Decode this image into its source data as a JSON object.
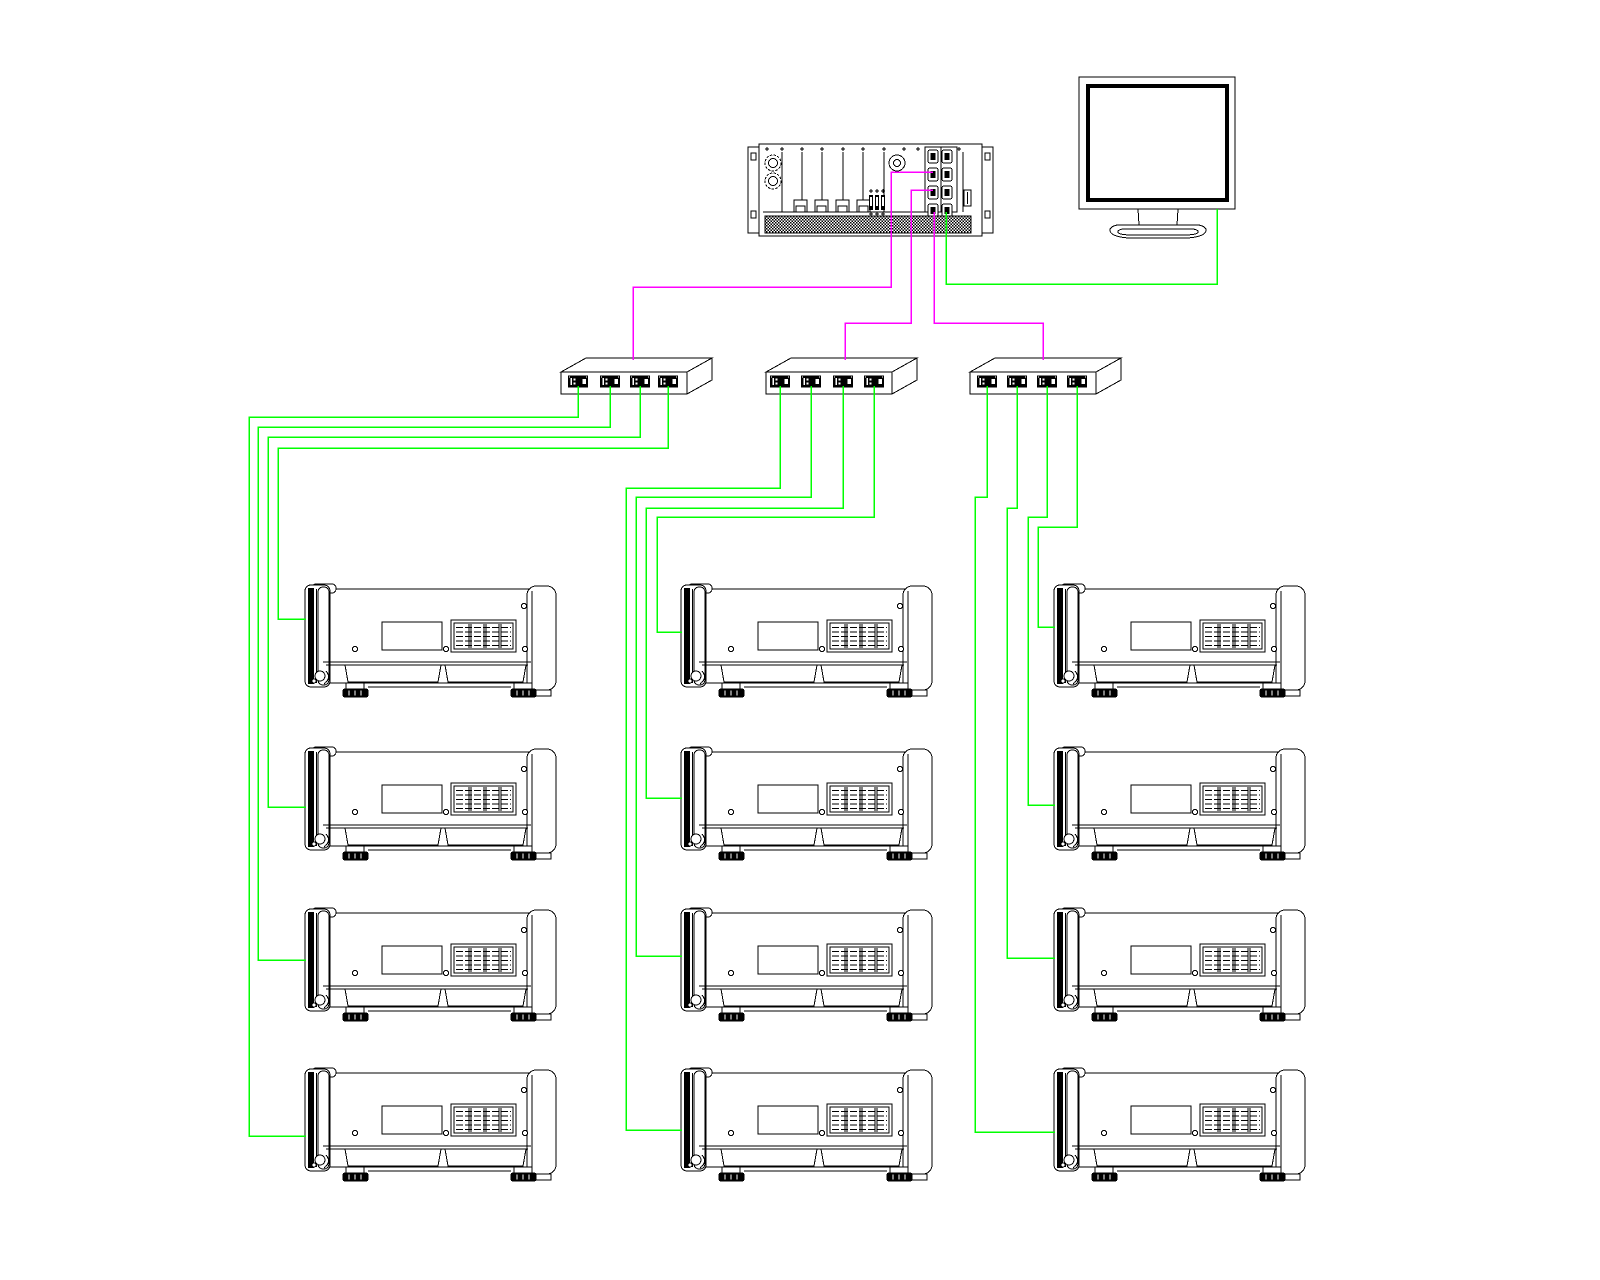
{
  "diagram": {
    "canvas": {
      "width": 1600,
      "height": 1280,
      "background": "#ffffff",
      "ink": "#000000"
    },
    "colors": {
      "video": "#ff00ff",
      "lan": "#00ff00"
    },
    "server": {
      "id": "rack-media-server",
      "x": 748,
      "y": 144,
      "width": 245,
      "height": 92
    },
    "monitor": {
      "id": "control-monitor",
      "x": 1079,
      "y": 77,
      "width": 156,
      "height": 161
    },
    "switches": [
      {
        "id": "splitter-1",
        "x": 561,
        "y": 358,
        "ports_x": [
          578,
          610,
          640,
          668
        ]
      },
      {
        "id": "splitter-2",
        "x": 766,
        "y": 358,
        "ports_x": [
          780,
          811,
          843,
          874
        ]
      },
      {
        "id": "splitter-3",
        "x": 970,
        "y": 358,
        "ports_x": [
          987,
          1017,
          1047,
          1077
        ]
      }
    ],
    "projectors": [
      {
        "id": "projector-left-1",
        "x": 305,
        "y": 583
      },
      {
        "id": "projector-middle-1",
        "x": 681,
        "y": 583
      },
      {
        "id": "projector-right-1",
        "x": 1054,
        "y": 583
      },
      {
        "id": "projector-left-2",
        "x": 305,
        "y": 746
      },
      {
        "id": "projector-middle-2",
        "x": 681,
        "y": 746
      },
      {
        "id": "projector-right-2",
        "x": 1054,
        "y": 746
      },
      {
        "id": "projector-left-3",
        "x": 305,
        "y": 907
      },
      {
        "id": "projector-middle-3",
        "x": 681,
        "y": 907
      },
      {
        "id": "projector-right-3",
        "x": 1054,
        "y": 907
      },
      {
        "id": "projector-left-4",
        "x": 305,
        "y": 1067
      },
      {
        "id": "projector-middle-4",
        "x": 681,
        "y": 1067
      },
      {
        "id": "projector-right-4",
        "x": 1054,
        "y": 1067
      }
    ],
    "cables": [
      {
        "kind": "video",
        "from": "server-out-1",
        "to": "splitter-1",
        "points": "933,172 891,172 891,287 633,287 633,360"
      },
      {
        "kind": "video",
        "from": "server-out-2",
        "to": "splitter-2",
        "points": "933,190 911,190 911,323 845,323 845,360"
      },
      {
        "kind": "video",
        "from": "server-out-3",
        "to": "splitter-3",
        "points": "934,212 934,323 1043,323 1043,360"
      },
      {
        "kind": "lan",
        "from": "server-lan",
        "to": "control-monitor",
        "points": "946,212 946,284 1217,284 1217,209"
      },
      {
        "kind": "lan",
        "from": "splitter-1-port-4",
        "to": "projector-left-1",
        "points": "668,386 668,448 278,448 278,619 306,619"
      },
      {
        "kind": "lan",
        "from": "splitter-1-port-3",
        "to": "projector-left-2",
        "points": "640,386 640,437 268,437 268,807 306,807"
      },
      {
        "kind": "lan",
        "from": "splitter-1-port-2",
        "to": "projector-left-3",
        "points": "610,386 610,427 258,427 258,960 306,960"
      },
      {
        "kind": "lan",
        "from": "splitter-1-port-1",
        "to": "projector-left-4",
        "points": "578,386 578,417 249,417 249,1136 306,1136"
      },
      {
        "kind": "lan",
        "from": "splitter-2-port-4",
        "to": "projector-middle-1",
        "points": "874,386 874,517 657,517 657,632 682,632"
      },
      {
        "kind": "lan",
        "from": "splitter-2-port-3",
        "to": "projector-middle-2",
        "points": "843,386 843,508 646,508 646,798 682,798"
      },
      {
        "kind": "lan",
        "from": "splitter-2-port-2",
        "to": "projector-middle-3",
        "points": "811,386 811,497 636,497 636,956 682,956"
      },
      {
        "kind": "lan",
        "from": "splitter-2-port-1",
        "to": "projector-middle-4",
        "points": "780,386 780,488 626,488 626,1130 682,1130"
      },
      {
        "kind": "lan",
        "from": "splitter-3-port-4",
        "to": "projector-right-1",
        "points": "1077,386 1077,527 1038,527 1038,627 1055,627"
      },
      {
        "kind": "lan",
        "from": "splitter-3-port-3",
        "to": "projector-right-2",
        "points": "1047,386 1047,517 1028,517 1028,805 1055,805"
      },
      {
        "kind": "lan",
        "from": "splitter-3-port-2",
        "to": "projector-right-3",
        "points": "1017,386 1017,508 1007,508 1007,958 1055,958"
      },
      {
        "kind": "lan",
        "from": "splitter-3-port-1",
        "to": "projector-right-4",
        "points": "987,386 987,497 975,497 975,1132 1055,1132"
      }
    ]
  }
}
